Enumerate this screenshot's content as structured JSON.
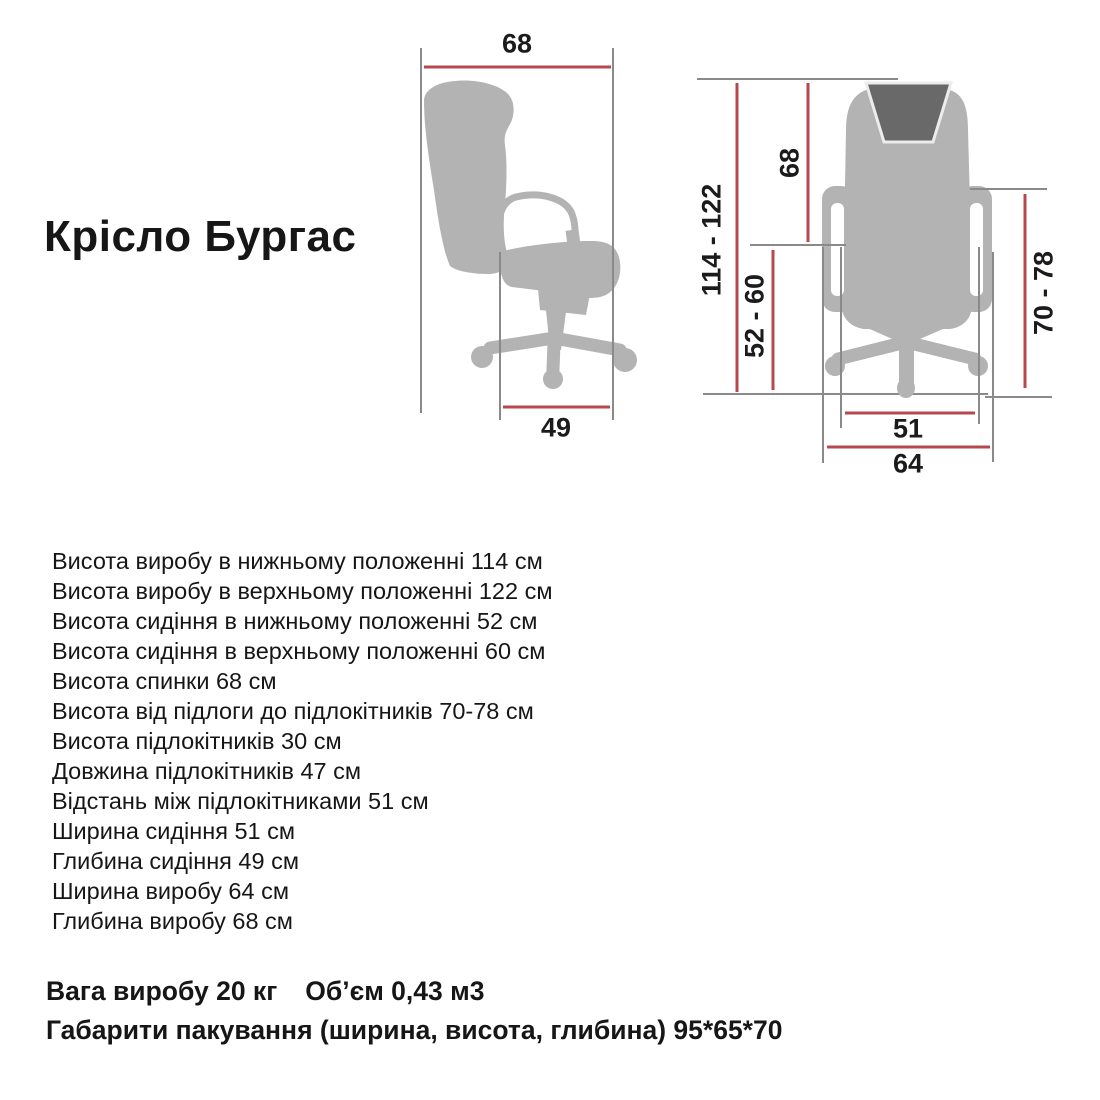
{
  "title": "Крісло Бургас",
  "colors": {
    "dimension_red": "#b5494e",
    "line_gray": "#8a8a8a",
    "chair_gray": "#b3b3b3",
    "headrest_gray": "#696969",
    "text_black": "#161616"
  },
  "side_view": {
    "depth_label": "68",
    "seat_depth_label": "49"
  },
  "front_view": {
    "product_height_label": "114 - 122",
    "back_height_label": "68",
    "seat_height_label": "52 - 60",
    "armrest_height_label": "70 - 78",
    "seat_width_label": "51",
    "product_width_label": "64"
  },
  "specs": {
    "lines": [
      "Висота виробу в нижньому положенні 114 см",
      "Висота виробу в верхньому положенні 122 см",
      "Висота сидіння в нижньому положенні 52 см",
      "Висота сидіння в верхньому положенні 60 см",
      "Висота спинки 68 см",
      "Висота від підлоги до підлокітників 70-78 см",
      "Висота підлокітників 30 см",
      "Довжина підлокітників 47 см",
      "Відстань між підлокітниками 51 см",
      "Ширина сидіння 51 см",
      "Глибина сидіння 49 см",
      "Ширина виробу 64 см",
      "Глибина виробу 68 см"
    ]
  },
  "footer": {
    "weight": "Вага виробу 20 кг",
    "volume": "Об’єм 0,43 м3",
    "packaging": "Габарити пакування (ширина, висота, глибина) 95*65*70"
  }
}
